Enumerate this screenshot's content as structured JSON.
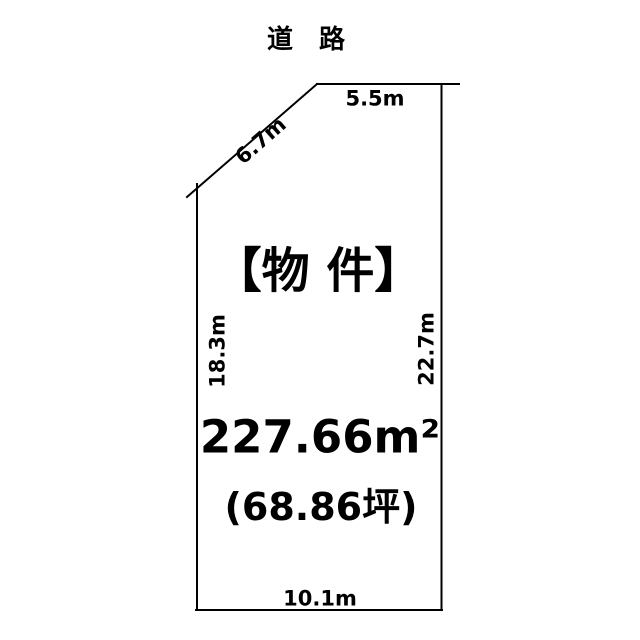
{
  "diagram": {
    "road_label": "道　路",
    "property_label": "【物 件】",
    "area_sqm": "227.66m²",
    "area_tsubo": "(68.86坪)",
    "dimensions": {
      "top": "5.5m",
      "diagonal": "6.7m",
      "left": "18.3m",
      "right": "22.7m",
      "bottom": "10.1m"
    },
    "colors": {
      "line": "#000000",
      "text": "#000000",
      "background": "#ffffff"
    }
  }
}
